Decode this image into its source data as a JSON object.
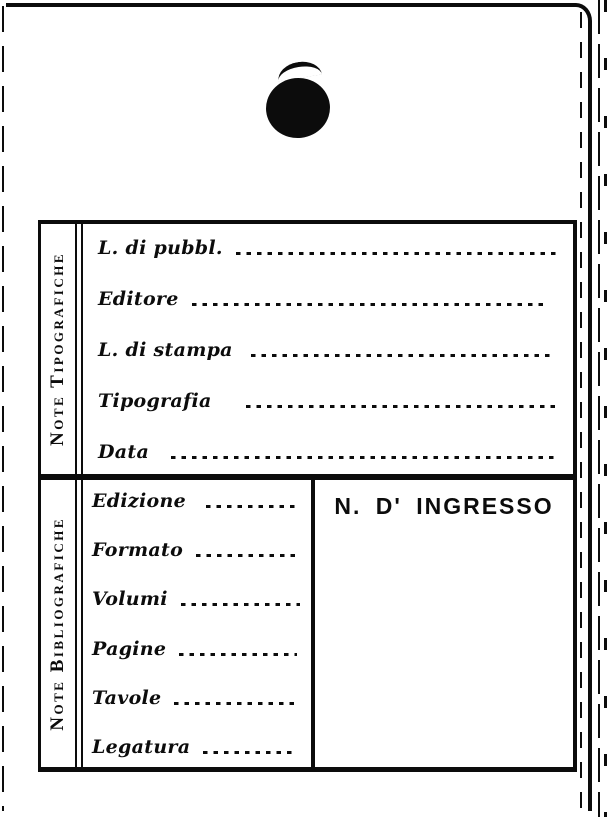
{
  "palette": {
    "ink": "#0c0c0c",
    "paper": "#ffffff"
  },
  "sections": {
    "tipografiche": {
      "side_label": "Note Tipografiche",
      "fields": [
        {
          "label": "L. di pubbl.",
          "value": ""
        },
        {
          "label": "Editore",
          "value": ""
        },
        {
          "label": "L. di stampa",
          "value": ""
        },
        {
          "label": "Tipografia",
          "value": ""
        },
        {
          "label": "Data",
          "value": ""
        }
      ]
    },
    "bibliografiche": {
      "side_label": "Note Bibliografiche",
      "fields": [
        {
          "label": "Edizione",
          "value": ""
        },
        {
          "label": "Formato",
          "value": ""
        },
        {
          "label": "Volumi",
          "value": ""
        },
        {
          "label": "Pagine",
          "value": ""
        },
        {
          "label": "Tavole",
          "value": ""
        },
        {
          "label": "Legatura",
          "value": ""
        }
      ],
      "ingresso_label": "N. D' INGRESSO"
    }
  }
}
